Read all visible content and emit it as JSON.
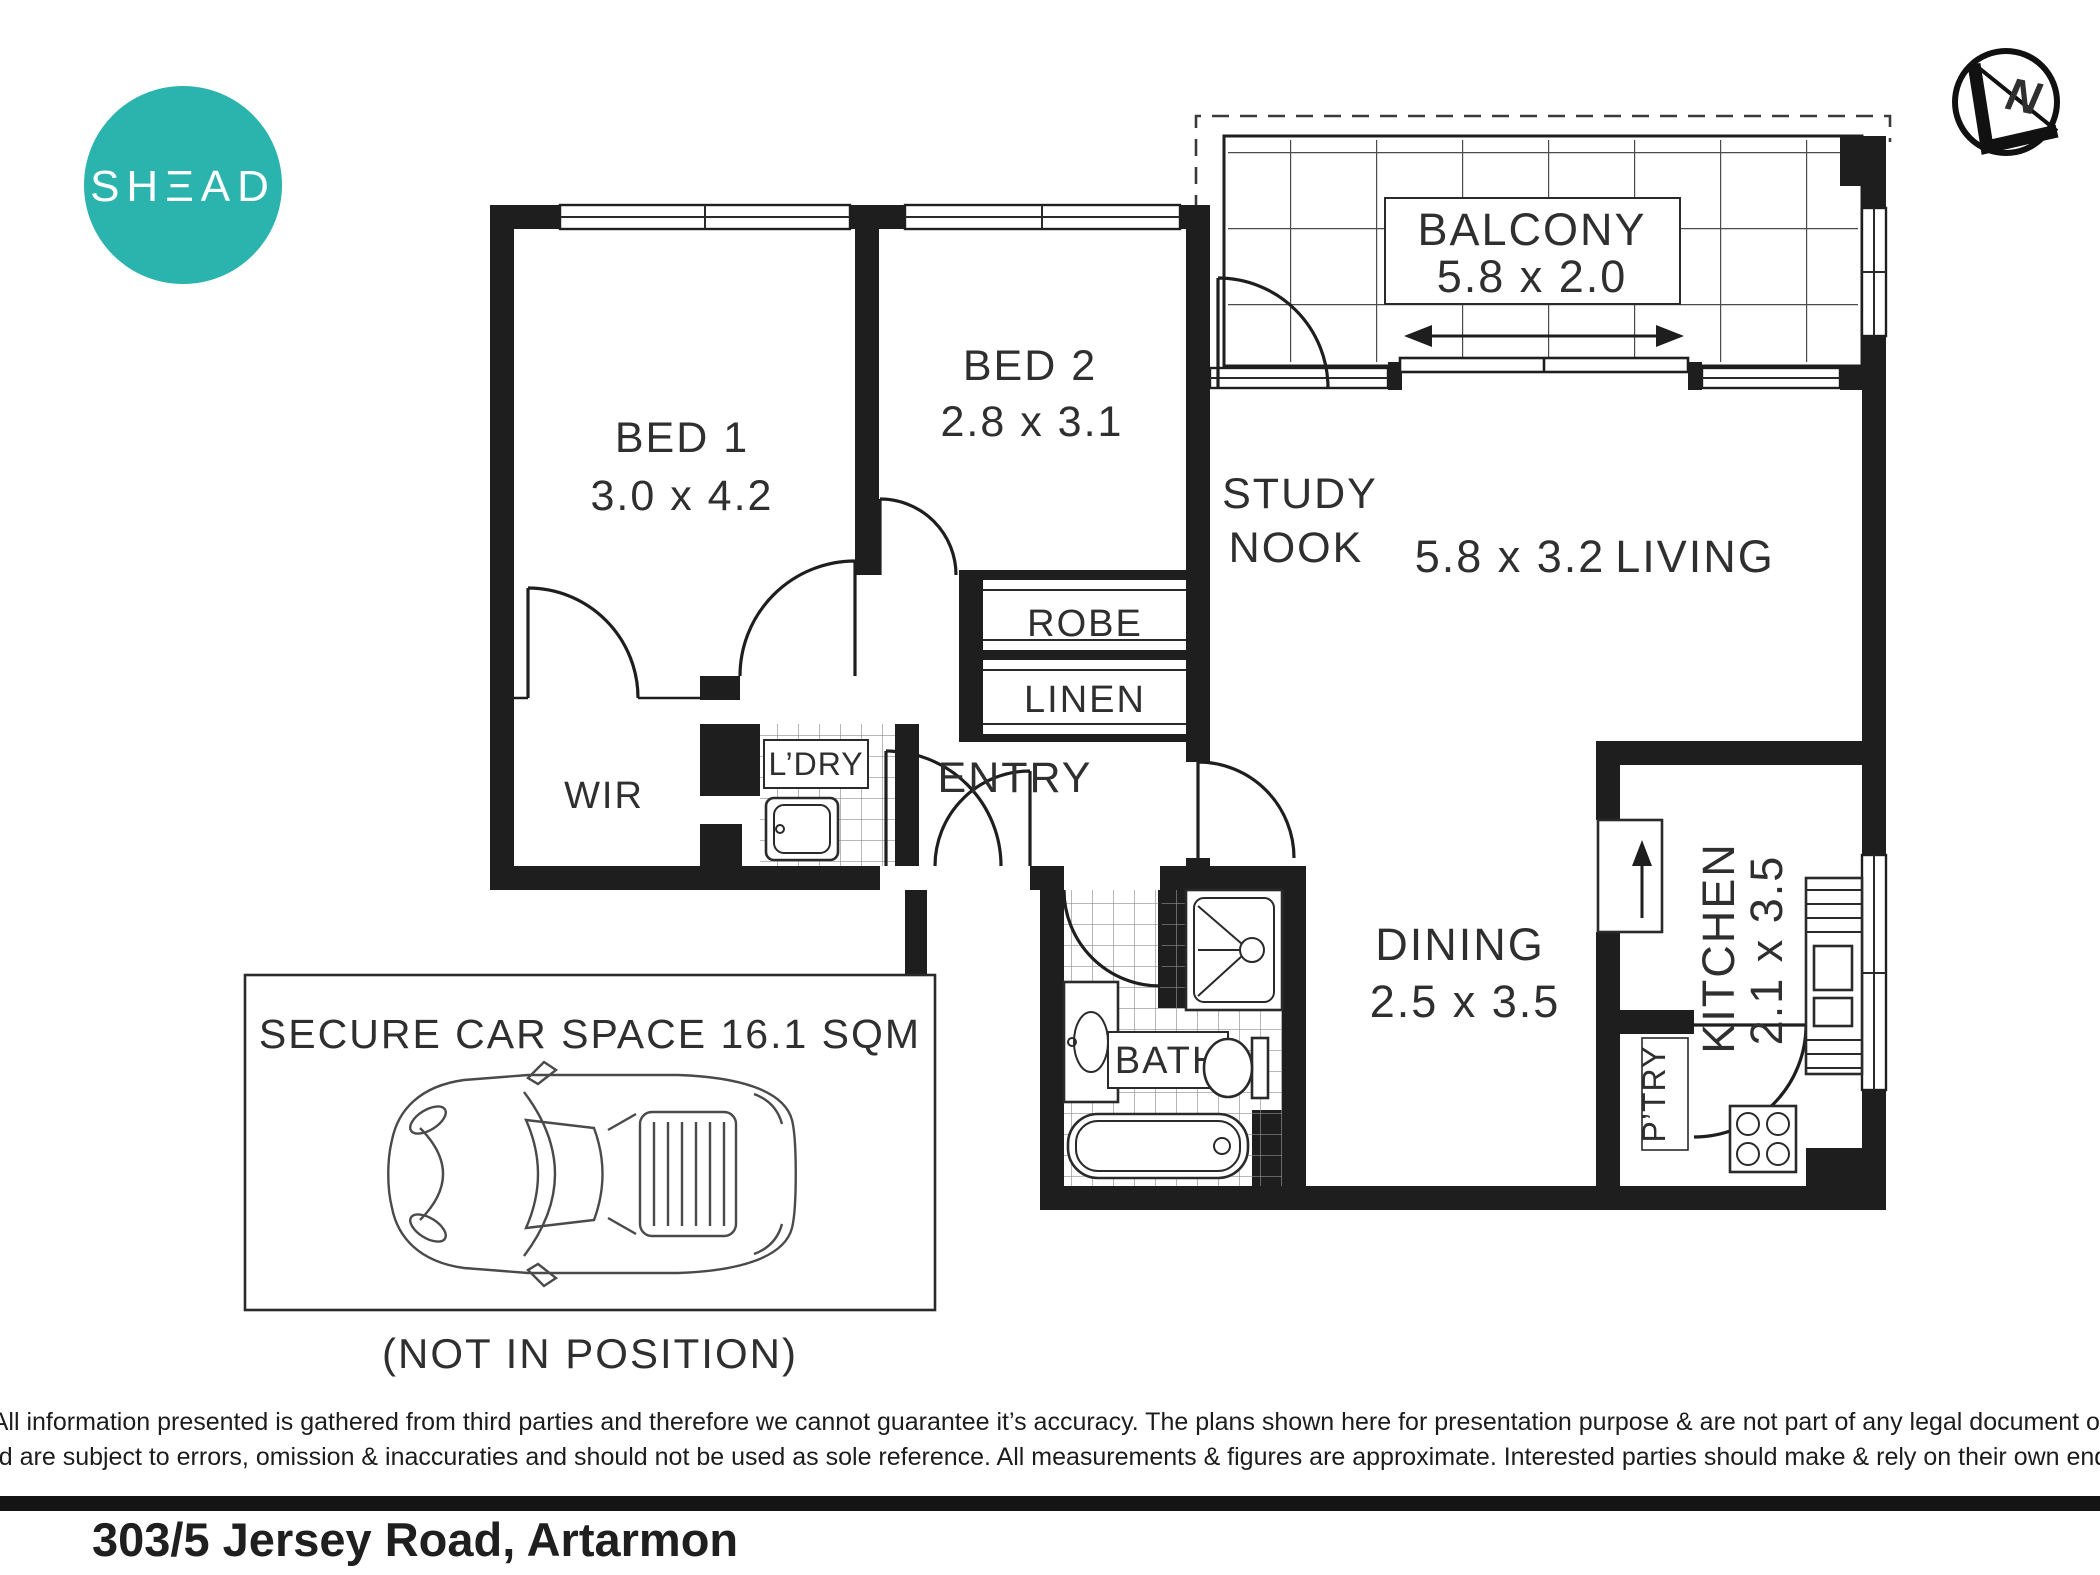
{
  "brand": {
    "logo_text": "SHΞAD",
    "logo_color": "#2BB3AE"
  },
  "compass": {
    "north_label": "N"
  },
  "plan": {
    "balcony": {
      "name": "BALCONY",
      "dims": "5.8 x 2.0"
    },
    "bed1": {
      "name": "BED 1",
      "dims": "3.0 x 4.2"
    },
    "bed2": {
      "name": "BED 2",
      "dims": "2.8 x 3.1"
    },
    "study_nook": {
      "line1": "STUDY",
      "line2": "NOOK"
    },
    "living": {
      "name": "LIVING",
      "dims": "5.8 x 3.2"
    },
    "robe": {
      "name": "ROBE"
    },
    "linen": {
      "name": "LINEN"
    },
    "wir": {
      "name": "WIR"
    },
    "laundry": {
      "name": "L’DRY"
    },
    "entry": {
      "name": "ENTRY"
    },
    "bath": {
      "name": "BATH"
    },
    "dining": {
      "name": "DINING",
      "dims": "2.5 x 3.5"
    },
    "kitchen": {
      "name": "KITCHEN",
      "dims": "2.1 x 3.5"
    },
    "pantry": {
      "name": "P’TRY"
    }
  },
  "car_space": {
    "title": "SECURE CAR SPACE 16.1 SQM",
    "note": "(NOT IN POSITION)"
  },
  "footer": {
    "disclaimer_line1": "All information presented is gathered from third parties and therefore we cannot guarantee it’s accuracy. The plans shown here for presentation purpose & are not part of any legal document or",
    "disclaimer_line2": "title and are subject to errors, omission & inaccuraties and should not be used as sole reference. All measurements & figures are approximate. Interested parties should make & rely on their own enquiries.",
    "address": "303/5 Jersey Road, Artarmon"
  }
}
